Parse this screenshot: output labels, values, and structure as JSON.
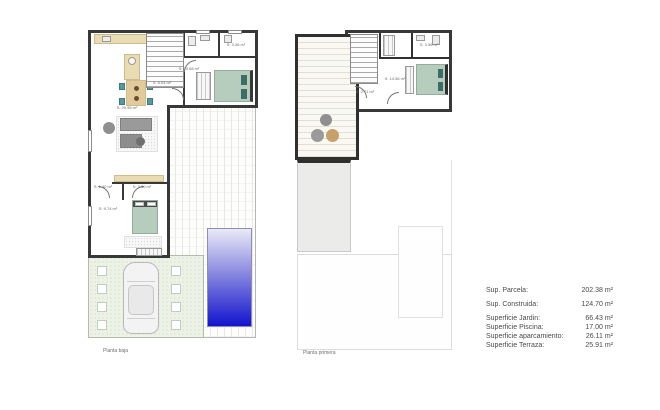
{
  "plans": {
    "ground": {
      "caption": "Planta baja",
      "rooms": {
        "kitchen_living": "S: 29.96 m²",
        "hall": "S: 5.04 m²",
        "bath_top": "S: 3.36 m²",
        "bedroom_top": "S: 10.68 m²",
        "corridor": "S: 1.40 m²",
        "bath_bottom": "S: 3.50 m²",
        "bedroom_bottom": "S: 9.74 m²"
      }
    },
    "first": {
      "caption": "Planta primera",
      "rooms": {
        "bath": "S: 3.36 m²",
        "bedroom": "S: 14.56 m²",
        "landing": "S: 2.71 m²"
      }
    }
  },
  "summary": {
    "rows": [
      {
        "label": "Sup. Parcela:",
        "value": "202.38 m²"
      },
      {
        "label": "Sup. Construida:",
        "value": "124.70 m²"
      },
      {
        "label": "Superficie Jardin:",
        "value": "66.43 m²"
      },
      {
        "label": "Superficie Piscina:",
        "value": "17.00 m²"
      },
      {
        "label": "Superficie aparcamiento:",
        "value": "26.11 m²"
      },
      {
        "label": "Superficie Terraza:",
        "value": "25.91 m²"
      }
    ]
  },
  "colors": {
    "wall": "#383838",
    "pool_top": "#e9e9f7",
    "pool_bottom": "#1313cf",
    "bed_green": "#b6cdbd",
    "pillow_teal": "#3c6e66",
    "chair_teal": "#57989c",
    "counter_beige": "#eadcb2",
    "garden_green": "#edf2e6",
    "pouf_tan": "#c8a06a",
    "sofa_gray": "#9a9a9a"
  }
}
